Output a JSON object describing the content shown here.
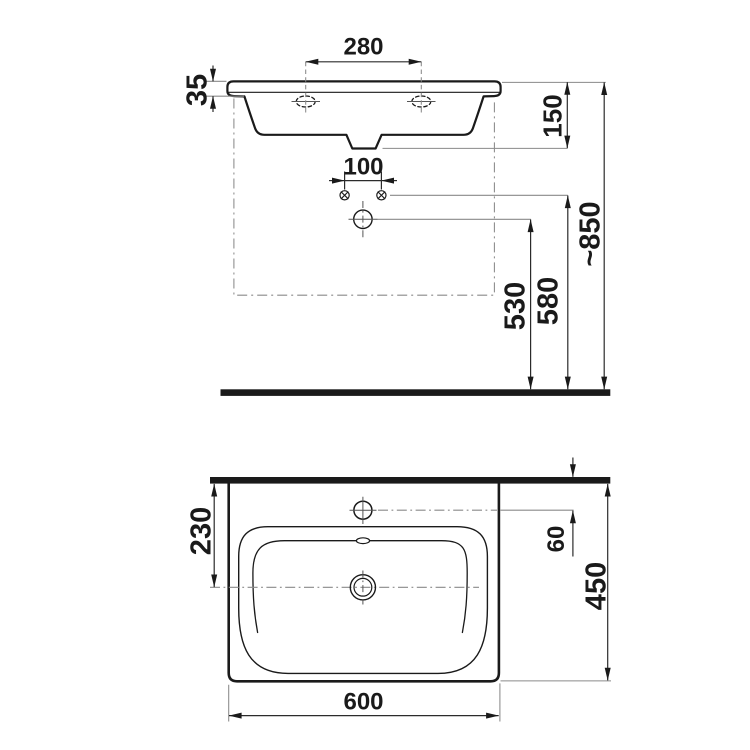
{
  "drawing": {
    "type": "washbasin-technical-dimension-drawing",
    "front_view": {
      "dimensions": {
        "tap_hole_spacing": "280",
        "rim_edge_height": "35",
        "fixing_hole_spacing": "100",
        "rim_to_waste_drop": "150",
        "waste_outlet_height": "530",
        "fixing_holes_height": "580",
        "installation_height": "~850"
      }
    },
    "plan_view": {
      "dimensions": {
        "wall_to_waste_centre": "230",
        "wall_to_tap_hole": "60",
        "depth": "450",
        "width": "600"
      }
    },
    "colors": {
      "object_line": "#1a1a1a",
      "dimension_line": "#2b2b2b",
      "auxiliary_line": "#8a8a8a",
      "background": "#ffffff"
    }
  }
}
